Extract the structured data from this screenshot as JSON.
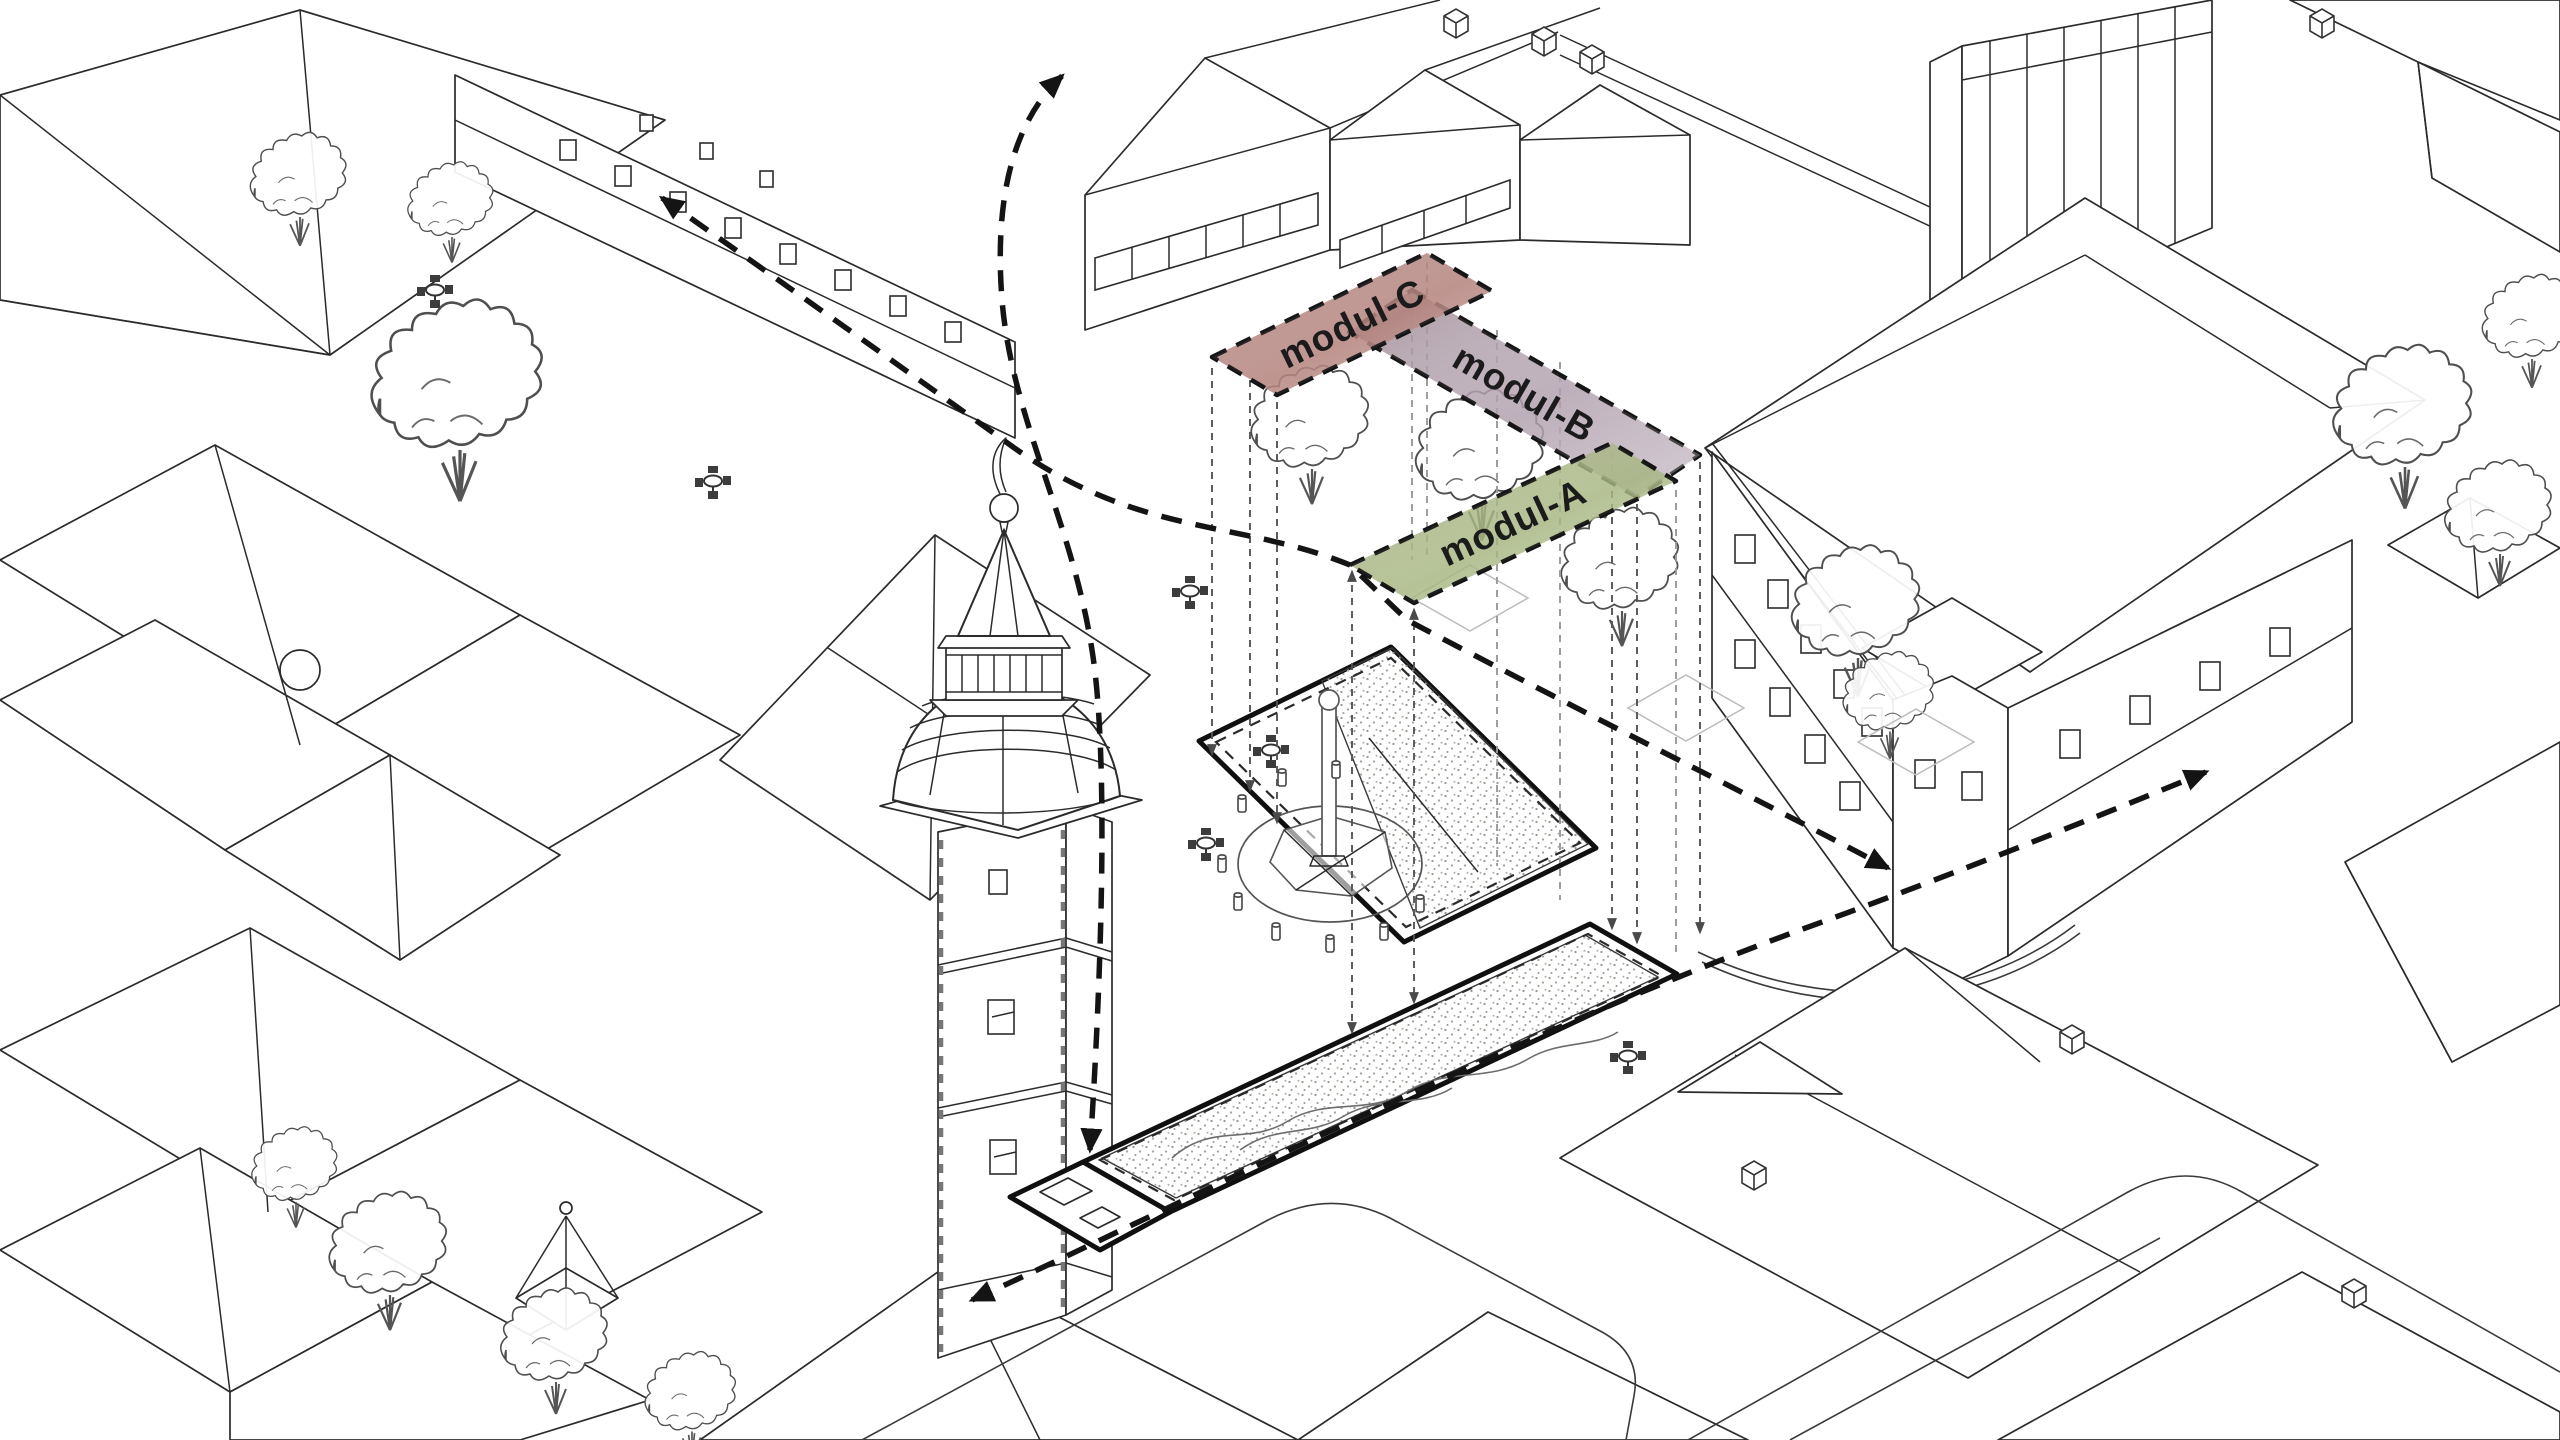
{
  "diagram": {
    "type": "axonometric-urban-plan",
    "background": "#ffffff",
    "ink": "#2b2b2b",
    "modules": [
      {
        "label": "modul-C",
        "fill": "#b4837c"
      },
      {
        "label": "modul-B",
        "fill": "#b09fac"
      },
      {
        "label": "modul-A",
        "fill": "#a6b47f"
      }
    ],
    "accents": {
      "bold_outline": "#101010",
      "stipple": "#949a90",
      "projection_line": "#5a5a5a",
      "flow_arrow": "#141414"
    },
    "landmarks": [
      {
        "name": "clock-tower-icon",
        "count": 1
      },
      {
        "name": "fountain-icon",
        "count": 1
      },
      {
        "name": "cafe-table-icon",
        "count": 6
      },
      {
        "name": "tree-icon",
        "count": 15
      },
      {
        "name": "flow-arrow",
        "count": 3
      },
      {
        "name": "plaza-plot",
        "count": 2
      }
    ]
  }
}
